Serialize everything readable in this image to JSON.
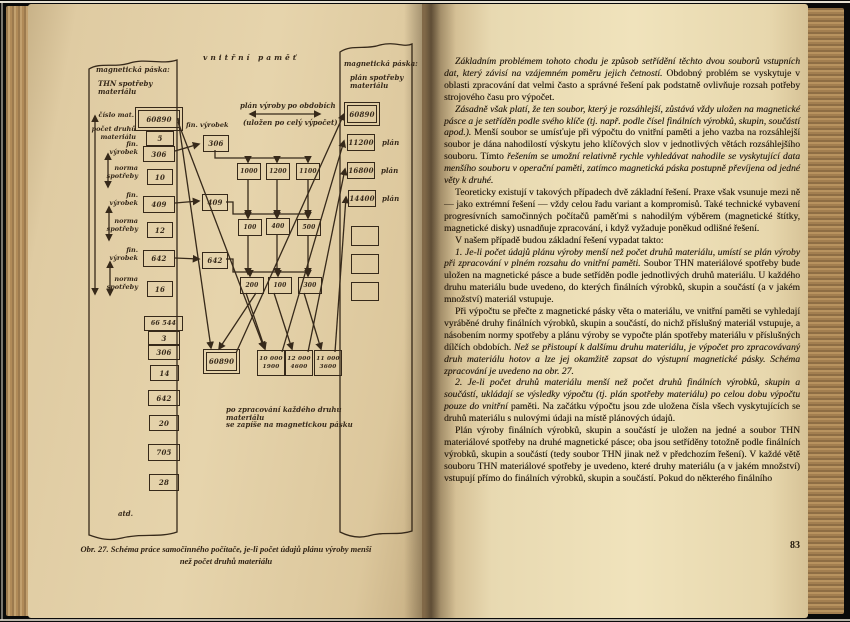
{
  "palette": {
    "background": "#0a0a0a",
    "left_page": "#e6d4ac",
    "right_page": "#f0e3bc",
    "ink": "#261c0f",
    "diagram_ink": "#36291a",
    "fore_edge": "#b8935f"
  },
  "book": {
    "left_page": {
      "diagram": {
        "inner_memory_title": "vnitřní paměť",
        "plan_header_line1": "plán výroby po obdobích",
        "plan_header_line2": "(uložen po celý výpočet)",
        "left_tape": {
          "title_line1": "magnetická páska:",
          "title_line2": "THN spotřeby materiálu",
          "rows": [
            {
              "label": "číslo mat.",
              "value": "60890"
            },
            {
              "label": "počet druhů materiálu",
              "value": "5"
            },
            {
              "label": "fin. výrobek",
              "value": "306"
            },
            {
              "label": "norma spotřeby",
              "value": "10"
            },
            {
              "label": "fin. výrobek",
              "value": "409"
            },
            {
              "label": "norma spotřeby",
              "value": "12"
            },
            {
              "label": "fin. výrobek",
              "value": "642"
            },
            {
              "label": "norma spotřeby",
              "value": "16"
            }
          ],
          "stack_values": [
            "66 544",
            "3",
            "306",
            "14",
            "642",
            "20",
            "705",
            "28"
          ],
          "etc_label": "atd."
        },
        "memory": {
          "fin_label": "fin. výrobek",
          "fin_boxes": [
            "306",
            "409",
            "642"
          ],
          "grid": [
            [
              "1000",
              "1200",
              "1100"
            ],
            [
              "100",
              "400",
              "500"
            ],
            [
              "200",
              "100",
              "300"
            ]
          ],
          "sum_boxes": [
            [
              "10 000",
              "1900"
            ],
            [
              "12 000",
              "4600"
            ],
            [
              "11 000",
              "3600"
            ]
          ],
          "material_box": "60890",
          "note_line1": "po zpracování každého druhu materiálu",
          "note_line2": "se zapíše na magnetickou pásku"
        },
        "right_tape": {
          "title_line1": "magnetická páska:",
          "title_line2": "plán spotřeby materiálu",
          "boxes": [
            {
              "value": "60890",
              "tag": ""
            },
            {
              "value": "11200",
              "tag": "plán"
            },
            {
              "value": "16800",
              "tag": "plán"
            },
            {
              "value": "14400",
              "tag": "plán"
            },
            {
              "value": "",
              "tag": ""
            },
            {
              "value": "",
              "tag": ""
            },
            {
              "value": "",
              "tag": ""
            }
          ]
        },
        "caption_line1": "Obr. 27. Schéma práce samočinného počítače, je-li počet údajů plánu výroby menší",
        "caption_line2": "než počet druhů materiálu"
      }
    },
    "right_page": {
      "page_number": "83",
      "paragraphs": [
        {
          "segments": [
            {
              "style": "i",
              "text": "Základním problémem tohoto chodu je způsob setřídění těchto dvou souborů vstupních dat, který závisí na vzájemném poměru jejich četností."
            },
            {
              "style": "r",
              "text": "Obdobný problém se vyskytuje v oblasti zpracování dat velmi často a správné řešení pak podstatně ovlivňuje rozsah potřeby strojového času pro výpočet."
            }
          ]
        },
        {
          "segments": [
            {
              "style": "i",
              "text": "Zásadně však platí, že ten soubor, který je rozsáhlejší, zůstává vždy uložen na magnetické pásce a je setříděn podle svého klíče (tj. např. podle čísel finálních výrobků, skupin, součástí apod.)."
            },
            {
              "style": "r",
              "text": "Menší soubor se umísťuje při výpočtu do vnitřní paměti a jeho vazba na rozsáhlejší soubor je dána nahodilostí výskytu jeho klíčových slov v jednotlivých větách rozsáhlejšího souboru. Tímto"
            },
            {
              "style": "i",
              "text": "řešením se umožní relativně rychle vyhledávat nahodile se vyskytující data menšího souboru v operační paměti, zatímco magnetická páska postupně převíjena od jedné věty k druhé."
            }
          ]
        },
        {
          "segments": [
            {
              "style": "r",
              "text": "Teoreticky existují v takových případech dvě základní řešení. Praxe však vsunuje mezi ně — jako extrémní řešení — vždy celou řadu variant a kompromisů. Také technické vybavení progresívních samočinných počítačů paměťmi s nahodilým výběrem (magnetické štítky, magnetické disky) usnadňuje zpracování, i když vyžaduje poněkud odlišné řešení."
            }
          ]
        },
        {
          "segments": [
            {
              "style": "r",
              "text": "V našem případě budou základní řešení vypadat takto:"
            }
          ]
        },
        {
          "segments": [
            {
              "style": "i",
              "text": "1. Je-li počet údajů plánu výroby menší než počet druhů materiálu, umístí se plán výroby při zpracování v plném rozsahu do vnitřní paměti."
            },
            {
              "style": "r",
              "text": "Soubor THN materiálové spotřeby bude uložen na magnetické pásce a bude setříděn podle jednotlivých druhů materiálu. U každého druhu materiálu bude uvedeno, do kterých finálních výrobků, skupin a součástí (a v jakém množství) materiál vstupuje."
            }
          ]
        },
        {
          "segments": [
            {
              "style": "r",
              "text": "Při výpočtu se přečte z magnetické pásky věta o materiálu, ve vnitřní paměti se vyhledají vyráběné druhy finálních výrobků, skupin a součástí, do nichž příslušný materiál vstupuje, a násobením normy spotřeby a plánu výroby se vypočte plán spotřeby materiálu v příslušných dílčích obdobích."
            },
            {
              "style": "i",
              "text": "Než se přistoupí k dalšímu druhu materiálu, je výpočet pro zpracovávaný druh materiálu hotov a lze jej okamžitě zapsat do výstupní magnetické pásky. Schéma zpracování je uvedeno na obr. 27."
            }
          ]
        },
        {
          "segments": [
            {
              "style": "i",
              "text": "2. Je-li počet druhů materiálu menší než počet druhů finálních výrobků, skupin a součástí, ukládají se výsledky výpočtu (tj. plán spotřeby materiálu) po celou dobu výpočtu pouze do vnitřní"
            },
            {
              "style": "r",
              "text": "paměti. Na začátku výpočtu jsou zde uložena čísla všech vyskytujících se druhů materiálu s nulovými údaji na místě plánových údajů."
            }
          ]
        },
        {
          "segments": [
            {
              "style": "r",
              "text": "Plán výroby finálních výrobků, skupin a součástí je uložen na jedné a soubor THN materiálové spotřeby na druhé magnetické pásce; oba jsou setříděny totožně podle finálních výrobků, skupin a součástí (tedy soubor THN jinak než v předchozím řešení). V každé větě souboru THN materiálové spotřeby je uvedeno, které druhy materiálu (a v jakém množství) vstupují přímo do finálních výrobků, skupin a součástí. Pokud do některého finálního"
            }
          ]
        }
      ]
    }
  }
}
